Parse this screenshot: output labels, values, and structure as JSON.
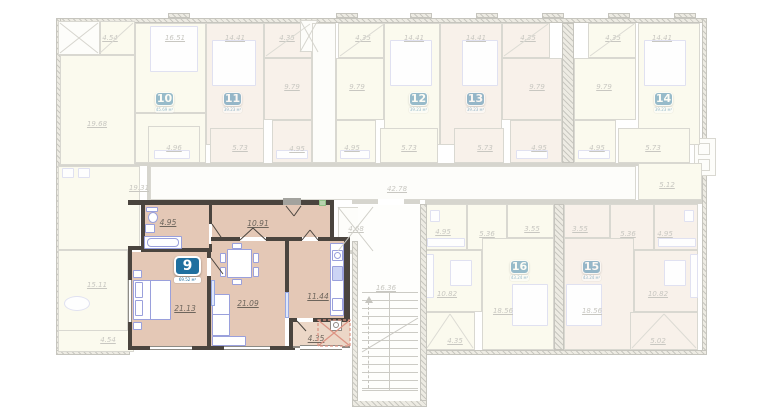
{
  "apartment9": {
    "number": "9",
    "area_caption": "69.52 м²",
    "rooms": {
      "bathroom": "4.95",
      "hallway": "10.91",
      "bedroom": "21.13",
      "living_room": "21.09",
      "kitchen": "11.44",
      "balcony": "4.35"
    }
  },
  "apartments": {
    "a10": {
      "number": "10",
      "area_caption": "45.69 м²",
      "rooms": {
        "balcony": "4.54",
        "bedroom": "16.51",
        "kitchen": "19.68",
        "bathroom": "4.96"
      }
    },
    "a11": {
      "number": "11",
      "area_caption": "39.23 м²",
      "rooms": {
        "bedroom": "14.41",
        "balcony": "4.35",
        "kitchen": "9.79",
        "hallway": "5.73",
        "bathroom": "4.95"
      }
    },
    "a12": {
      "number": "12",
      "area_caption": "39.23 м²",
      "rooms": {
        "balcony": "4.35",
        "kitchen": "9.79",
        "bedroom": "14.41",
        "bathroom": "4.95",
        "hallway": "5.73"
      }
    },
    "a13": {
      "number": "13",
      "area_caption": "39.23 м²",
      "rooms": {
        "bedroom": "14.41",
        "balcony": "4.35",
        "kitchen": "9.79",
        "hallway": "5.73",
        "bathroom": "4.95"
      }
    },
    "a14": {
      "number": "14",
      "area_caption": "39.23 м²",
      "rooms": {
        "balcony": "4.35",
        "kitchen": "9.79",
        "bedroom": "14.41",
        "bathroom": "4.95",
        "hallway": "5.73",
        "storage": "5.12"
      }
    },
    "a16": {
      "number": "16",
      "area_caption": "43.24 м²",
      "rooms": {
        "bathroom": "4.95",
        "hallway": "5.36",
        "wardrobe": "3.55",
        "kitchen": "10.82",
        "bedroom": "18.56",
        "balcony": "4.35"
      }
    },
    "a15": {
      "number": "15",
      "area_caption": "43.24 м²",
      "rooms": {
        "wardrobe": "3.55",
        "hallway": "5.36",
        "bathroom": "4.95",
        "bedroom": "18.56",
        "kitchen": "10.82",
        "balcony": "5.02"
      }
    }
  },
  "common_areas": {
    "corridor": "42.78",
    "staircase": "16.36",
    "elevator": "4.68"
  },
  "adjacent_left": {
    "living": "19.31",
    "room": "15.11",
    "balcony": "4.54"
  },
  "colors": {
    "highlight_fill": "#e4c8b6",
    "badge_blue": "#1f6f9f",
    "wall_dark": "#4a443e",
    "faded_yellow": "#fbfaee",
    "faded_pink": "#f8f1ea",
    "balcony_cross_red": "#dd9383"
  }
}
